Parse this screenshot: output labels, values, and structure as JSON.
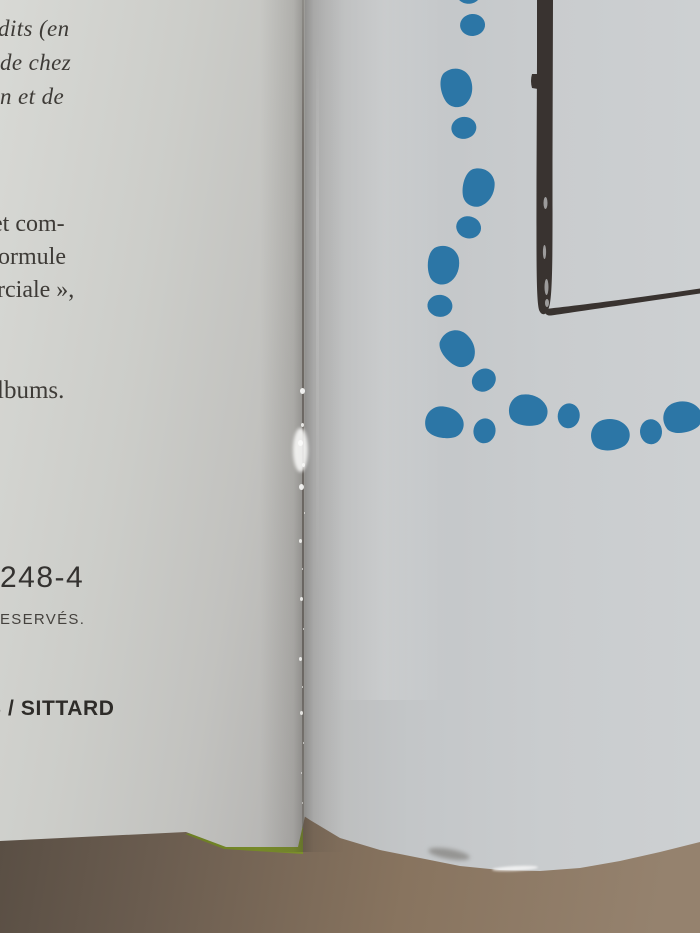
{
  "left_page": {
    "italic_lines": [
      "dits (en",
      "de chez",
      "n et de"
    ],
    "body_lines": [
      "et com-",
      "ormule",
      "rciale »,"
    ],
    "albums_line": "lbums.",
    "isbn_fragment": "248-4",
    "rights_fragment": "ESERVÉS.",
    "imprint_fragment": "S / SITTARD"
  },
  "right_page": {
    "illustration": {
      "footprint_color": "#2c76a6",
      "frame_color": "#393330",
      "footprints": [
        {
          "x": 472,
          "y": 10,
          "angle": -4
        },
        {
          "x": 462,
          "y": 113,
          "angle": -9
        },
        {
          "x": 473,
          "y": 213,
          "angle": 15
        },
        {
          "x": 442,
          "y": 291,
          "angle": 6
        },
        {
          "x": 475,
          "y": 368,
          "angle": -38
        },
        {
          "x": 470,
          "y": 427,
          "angle": -77
        },
        {
          "x": 554,
          "y": 413,
          "angle": -81
        },
        {
          "x": 636,
          "y": 432,
          "angle": -93
        },
        {
          "x": 708,
          "y": 413,
          "angle": -96
        }
      ]
    }
  },
  "colors": {
    "paper_left": "#cbccc9",
    "paper_right": "#c6c9cb",
    "table_brown": "#83705f",
    "cover_green": "#93ab35",
    "gutter_crease": "#6e6a66"
  }
}
